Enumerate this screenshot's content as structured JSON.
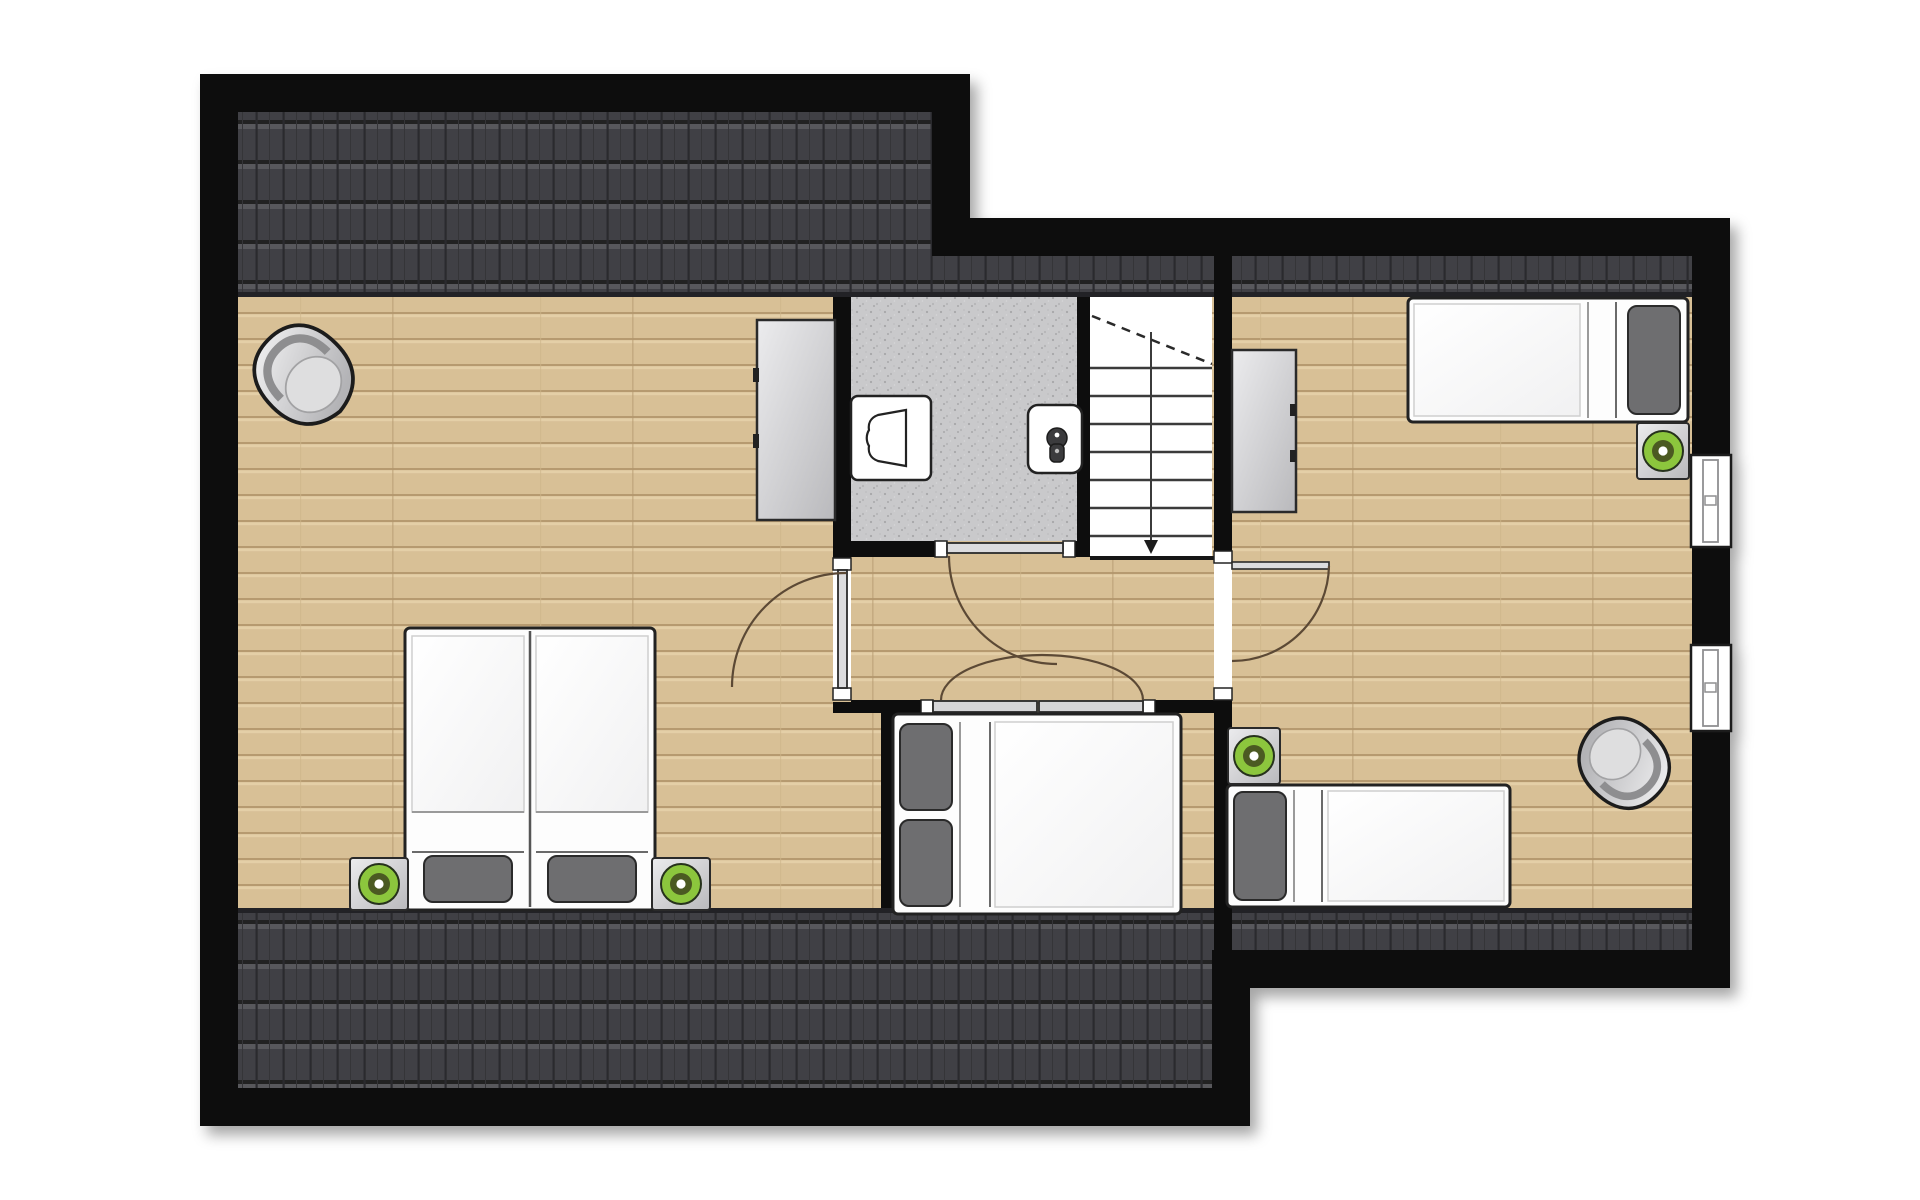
{
  "document": {
    "type": "architectural floor plan, top view",
    "floor_label": "attic / upper floor with dormer layout",
    "visible_text": []
  },
  "colors": {
    "wall": "#0e0e0f",
    "roof-base": "#454548",
    "roof-line": "#222224",
    "wood": "#d8c096",
    "wood-line": "#a88b60",
    "tile": "#c9c9cb",
    "fixture-white": "#ffffff",
    "furniture-grey": "#c9c9cb",
    "pillow-grey": "#6e6e70",
    "lamp-green": "#8cc63e",
    "lamp-ring": "#4c5a20",
    "door-arc": "#5b4a36",
    "stair-line": "#3a3a3a"
  },
  "rooms": [
    {
      "id": "bedroom-left",
      "furniture": [
        "corner chair",
        "wardrobe",
        "double bed of two singles",
        "two nightstands with green lamps"
      ]
    },
    {
      "id": "bathroom",
      "floor": "grey tile",
      "fixtures": [
        "toilet",
        "washbasin"
      ]
    },
    {
      "id": "staircase",
      "details": [
        "seven treads",
        "center divider with down arrow",
        "dashed headroom cut line"
      ]
    },
    {
      "id": "landing",
      "doors": [
        "single door to left bedroom",
        "bathroom door",
        "double doors to middle bedroom",
        "single door to right bedroom"
      ]
    },
    {
      "id": "bedroom-middle",
      "furniture": [
        "double bed with two pillows"
      ]
    },
    {
      "id": "bedroom-right",
      "furniture": [
        "single bed top",
        "single bed bottom",
        "two nightstands with green lamps",
        "wardrobe",
        "corner chair"
      ],
      "windows": 2
    }
  ],
  "counts": {
    "beds": 4,
    "green_lamps": 4,
    "nightstands": 4,
    "wardrobes": 2,
    "corner_chairs": 2,
    "windows": 2,
    "interior_doors": 4,
    "toilets": 1,
    "washbasins": 1
  }
}
